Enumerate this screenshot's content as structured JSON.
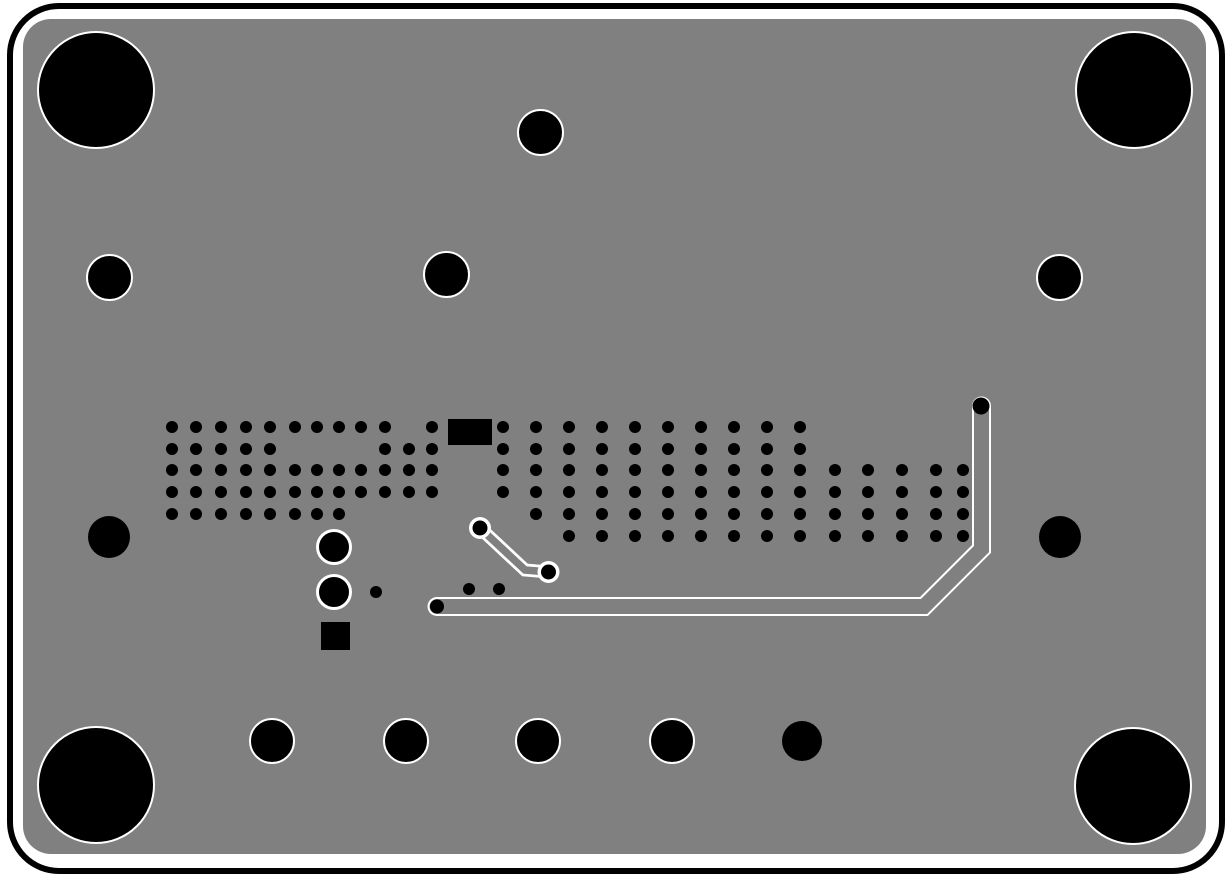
{
  "view": {
    "kind": "pcb-bottom-copper-layer",
    "width": 1232,
    "height": 882,
    "colors": {
      "background": "#ffffff",
      "board": "#808080",
      "copper_drill": "#000000",
      "clearance": "#ffffff"
    }
  },
  "board": {
    "outline": {
      "x": 7,
      "y": 3,
      "w": 1218,
      "h": 871,
      "stroke": 6,
      "radius": 52
    },
    "surface": {
      "x": 23,
      "y": 19,
      "w": 1183,
      "h": 835,
      "radius": 28
    }
  },
  "holes": [
    {
      "cx": 96,
      "cy": 90,
      "r": 57,
      "ring": 2.5,
      "name": "mounting-hole-top-left"
    },
    {
      "cx": 1134,
      "cy": 90,
      "r": 57,
      "ring": 2.5,
      "name": "mounting-hole-top-right"
    },
    {
      "cx": 96,
      "cy": 785,
      "r": 57,
      "ring": 2.5,
      "name": "mounting-hole-bottom-left"
    },
    {
      "cx": 1133,
      "cy": 786,
      "r": 57,
      "ring": 2.5,
      "name": "mounting-hole-bottom-right"
    },
    {
      "cx": 110,
      "cy": 278,
      "r": 21.5,
      "ring": 2.5,
      "name": "drill-hole"
    },
    {
      "cx": 447,
      "cy": 275,
      "r": 21.5,
      "ring": 2.5,
      "name": "drill-hole"
    },
    {
      "cx": 541,
      "cy": 133,
      "r": 21.5,
      "ring": 2.5,
      "name": "drill-hole"
    },
    {
      "cx": 1060,
      "cy": 278,
      "r": 21.5,
      "ring": 2.5,
      "name": "drill-hole"
    },
    {
      "cx": 109,
      "cy": 537,
      "r": 21,
      "ring": 0,
      "name": "drill-hole-unplated"
    },
    {
      "cx": 1060,
      "cy": 537,
      "r": 21,
      "ring": 0,
      "name": "drill-hole-unplated"
    },
    {
      "cx": 272,
      "cy": 741,
      "r": 21,
      "ring": 2.5,
      "name": "drill-hole"
    },
    {
      "cx": 406,
      "cy": 741,
      "r": 21,
      "ring": 2.5,
      "name": "drill-hole"
    },
    {
      "cx": 538,
      "cy": 741,
      "r": 21,
      "ring": 2.5,
      "name": "drill-hole"
    },
    {
      "cx": 672,
      "cy": 741,
      "r": 21,
      "ring": 2.5,
      "name": "drill-hole"
    },
    {
      "cx": 802,
      "cy": 741,
      "r": 20,
      "ring": 0,
      "name": "drill-hole-unplated"
    }
  ],
  "plated_pads": [
    {
      "cx": 334,
      "cy": 547,
      "r": 15,
      "ring": 3
    },
    {
      "cx": 334,
      "cy": 592,
      "r": 15,
      "ring": 3
    }
  ],
  "smd_pads": [
    {
      "x": 448,
      "y": 419,
      "w": 44,
      "h": 26,
      "shape": "rect"
    },
    {
      "x": 321,
      "y": 622,
      "w": 29,
      "h": 28,
      "shape": "square"
    }
  ],
  "via_field": {
    "dot_radius": 6,
    "rows": [
      {
        "y": 427,
        "x": [
          172,
          196,
          221,
          246,
          270,
          295,
          317,
          339,
          361,
          385,
          432,
          503,
          536,
          569,
          602,
          635,
          668,
          701,
          734,
          767,
          800
        ]
      },
      {
        "y": 449,
        "x": [
          172,
          196,
          221,
          246,
          270,
          385,
          409,
          432,
          503,
          536,
          569,
          602,
          635,
          668,
          701,
          734,
          767,
          800
        ]
      },
      {
        "y": 470,
        "x": [
          172,
          196,
          221,
          246,
          270,
          295,
          317,
          339,
          361,
          385,
          409,
          432,
          503,
          536,
          569,
          602,
          635,
          668,
          701,
          734,
          767,
          800,
          835,
          868,
          902,
          936,
          963
        ]
      },
      {
        "y": 492,
        "x": [
          172,
          196,
          221,
          246,
          270,
          295,
          317,
          339,
          361,
          385,
          409,
          432,
          503,
          536,
          569,
          602,
          635,
          668,
          701,
          734,
          767,
          800,
          835,
          868,
          902,
          936,
          963
        ]
      },
      {
        "y": 514,
        "x": [
          172,
          196,
          221,
          246,
          270,
          295,
          317,
          339,
          536,
          569,
          602,
          635,
          668,
          701,
          734,
          767,
          800,
          835,
          868,
          902,
          936,
          963
        ]
      },
      {
        "y": 536,
        "x": [
          569,
          602,
          635,
          668,
          701,
          734,
          767,
          800,
          835,
          868,
          902,
          936,
          963
        ]
      },
      {
        "y": 589,
        "x": [
          469,
          499
        ]
      },
      {
        "y": 592,
        "x": [
          376
        ]
      }
    ]
  },
  "traces": [
    {
      "name": "main-signal-trace",
      "points": [
        [
          437,
          606.5
        ],
        [
          924,
          606.5
        ],
        [
          981.5,
          549
        ],
        [
          981.5,
          406
        ]
      ],
      "outline_width": 19,
      "core_width": 15,
      "end_vias": [
        {
          "cx": 437,
          "cy": 606.5,
          "r": 7,
          "ring": 0
        },
        {
          "cx": 981,
          "cy": 406,
          "r": 8.5,
          "ring": 0
        }
      ]
    },
    {
      "name": "short-spur-trace",
      "points": [
        [
          480,
          528
        ],
        [
          525,
          570
        ],
        [
          548.5,
          572
        ]
      ],
      "outline_width": 13,
      "core_width": 7.5,
      "end_vias": [
        {
          "cx": 480,
          "cy": 528,
          "r": 7.5,
          "ring": 3.5
        },
        {
          "cx": 548.5,
          "cy": 572,
          "r": 7.5,
          "ring": 3.5
        }
      ]
    }
  ]
}
